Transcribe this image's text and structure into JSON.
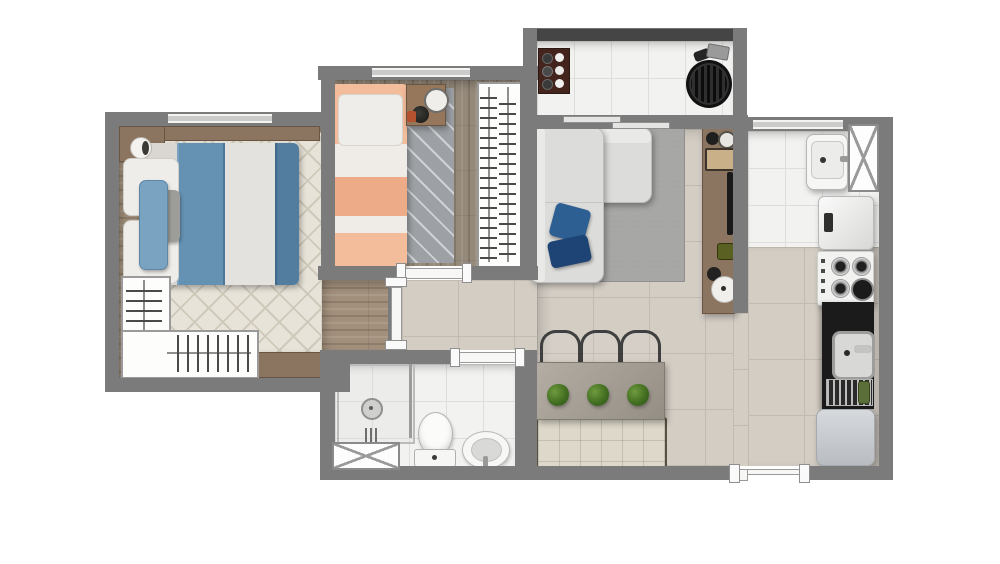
{
  "scene": {
    "description": "top-down 3D rendered floor plan of a one-level apartment, no text labels",
    "rooms": [
      {
        "name": "master-bedroom",
        "furniture": [
          "double-bed-blue",
          "white-pillows",
          "blue-pillow",
          "gray-pillow",
          "headboard-shelf",
          "lamp",
          "diamond-rug",
          "l-shaped-wardrobe-open",
          "wood-dresser",
          "window"
        ]
      },
      {
        "name": "bedroom-2",
        "furniture": [
          "single-bed-peach-stripes",
          "white-pillow",
          "nightstand",
          "clock",
          "plant-pot",
          "chevron-runner-rug",
          "open-wardrobe-hangers",
          "window"
        ]
      },
      {
        "name": "living-room",
        "furniture": [
          "l-shaped-sofa-gray",
          "two-blue-throw-pillows",
          "speckled-gray-rug",
          "tv-console",
          "tv",
          "decor-objects"
        ]
      },
      {
        "name": "dining-area",
        "furniture": [
          "rectangular-table",
          "three-dark-chairs",
          "three-potted-plants",
          "tufted-bench"
        ]
      },
      {
        "name": "balcony",
        "furniture": [
          "glass-guardrail",
          "plate-shelf",
          "round-grill",
          "sliding-door"
        ]
      },
      {
        "name": "laundry-area",
        "furniture": [
          "laundry-tank-sink",
          "washing-machine",
          "hatched-duct-shaft",
          "window"
        ]
      },
      {
        "name": "kitchen",
        "furniture": [
          "four-burner-stove",
          "black-counter-with-steel-sink",
          "dish-rack-with-plates",
          "refrigerator"
        ]
      },
      {
        "name": "bathroom",
        "furniture": [
          "shower-box-glass",
          "shower-head",
          "toilet",
          "round-basin",
          "hatched-duct-shaft",
          "door"
        ]
      }
    ],
    "doors": [
      "master-bedroom-door",
      "bedroom-2-door",
      "bathroom-door",
      "balcony-sliding-door",
      "entry-door-bottom"
    ],
    "background": "#ffffff"
  },
  "colors": {
    "wall": "#7b7b7b",
    "rail": "#454545",
    "wood1": "#a3907c",
    "wood2": "#958a7a",
    "tile": "#f2f2f1",
    "grout": "#dededc",
    "beige": "#d3cdc4",
    "bgrout": "#c1bbb1",
    "rug1": "#e7e3d9",
    "rug1line": "#cfc9ba",
    "rug2": "#9da0a4",
    "rug2line": "#ced1d5",
    "rug3": "#a7a7a5",
    "sofa": "#dcdcda",
    "blue": "#6591b2",
    "blued": "#537d9f",
    "duvet": "#e3e2de",
    "pw": "#efede9",
    "peach": "#f3bc9b",
    "peachd": "#eeab88",
    "sheet": "#efece7",
    "wood": "#8b7460",
    "woodd": "#6a5442",
    "black": "#1b1b1b",
    "steel": "#c2c2c0",
    "white": "#f5f5f4",
    "fridge": "#c9ccd1",
    "plant": "#4c7a2c",
    "bench": "#ddd8ca",
    "chair": "#3f3f3f",
    "table": "#a39d94",
    "shelf": "#44251d",
    "hanger": "#4a4a4a",
    "glass": "#e4e4e3"
  }
}
